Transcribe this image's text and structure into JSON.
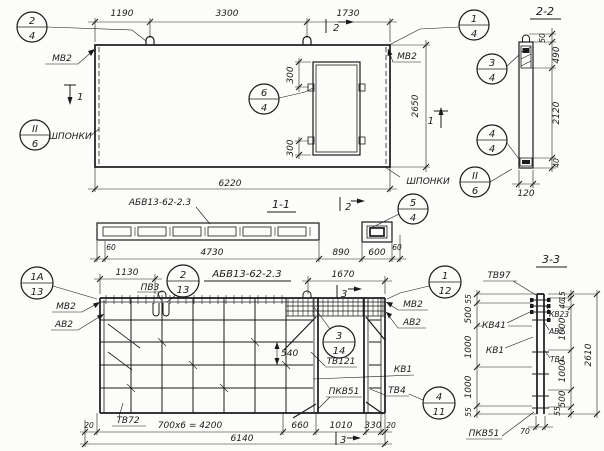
{
  "plan": {
    "dims": {
      "a": "1190",
      "b": "3300",
      "c": "1730",
      "total": "6220",
      "height": "2650",
      "open_top": "300",
      "open_bot": "300"
    },
    "labels": {
      "mv2_left": "МВ2",
      "shponki_left": "ШПОНКИ",
      "mv2_right": "МВ2",
      "shponki_right": "ШПОНКИ"
    },
    "markers": {
      "top": "2",
      "left": "1",
      "right": "1"
    },
    "callouts": {
      "c24": {
        "num": "2",
        "den": "4"
      },
      "c26l": {
        "num": "II",
        "den": "6"
      },
      "c64": {
        "num": "6",
        "den": "4"
      },
      "c14": {
        "num": "1",
        "den": "4"
      },
      "c26r": {
        "num": "II",
        "den": "6"
      }
    }
  },
  "section22": {
    "title": "2-2",
    "dims": {
      "d50": "50",
      "d490": "490",
      "d2120": "2120",
      "d40": "40",
      "d120": "120"
    },
    "callouts": {
      "c34": {
        "num": "3",
        "den": "4"
      },
      "c44": {
        "num": "4",
        "den": "4"
      }
    }
  },
  "section11": {
    "title": "1-1",
    "label": "АБВ13-62-2.3",
    "marker": "2",
    "callouts": {
      "c54": {
        "num": "5",
        "den": "4"
      }
    },
    "dims": {
      "d60l": "60",
      "d4730": "4730",
      "d890": "890",
      "d600": "600",
      "d60r": "60"
    }
  },
  "elevation": {
    "heading": "АБВ13-62-2.3",
    "markers": {
      "top": "3",
      "bottom": "3"
    },
    "labels": {
      "pv3": "ПВ3",
      "mv2_left": "МВ2",
      "av2_left": "АВ2",
      "mv2_right": "МВ2",
      "av2_right": "АВ2",
      "tv121": "ТВ121",
      "kv1": "КВ1",
      "pkv51": "ПКВ51",
      "tv4": "ТВ4",
      "tv72": "ТВ72"
    },
    "dims": {
      "d1130": "1130",
      "d1670": "1670",
      "d540": "540",
      "d20l": "20",
      "d4200": "700х6 = 4200",
      "d660": "660",
      "d1010": "1010",
      "d330": "330",
      "d20r": "20",
      "d6140": "6140"
    },
    "callouts": {
      "c1a13": {
        "num": "1А",
        "den": "13"
      },
      "c213": {
        "num": "2",
        "den": "13"
      },
      "c112": {
        "num": "1",
        "den": "12"
      },
      "c314": {
        "num": "3",
        "den": "14"
      },
      "c411": {
        "num": "4",
        "den": "11"
      }
    }
  },
  "section33": {
    "title": "3-3",
    "labels": {
      "tv97": "ТВ97",
      "kv41": "КВ41",
      "kv1": "КВ1",
      "pkv51": "ПКВ51",
      "kv23": "КВ23",
      "av2": "АВ2",
      "tv4": "ТВ4"
    },
    "dims_left": {
      "d55t": "55",
      "d500": "500",
      "d1000a": "1000",
      "d1000b": "1000",
      "d55b": "55"
    },
    "dims_right": {
      "d15": "15",
      "d40": "40",
      "d1000a": "1000",
      "d1000b": "1000",
      "d500": "500",
      "d55": "55"
    },
    "dims": {
      "total": "2610",
      "d70": "70"
    }
  }
}
